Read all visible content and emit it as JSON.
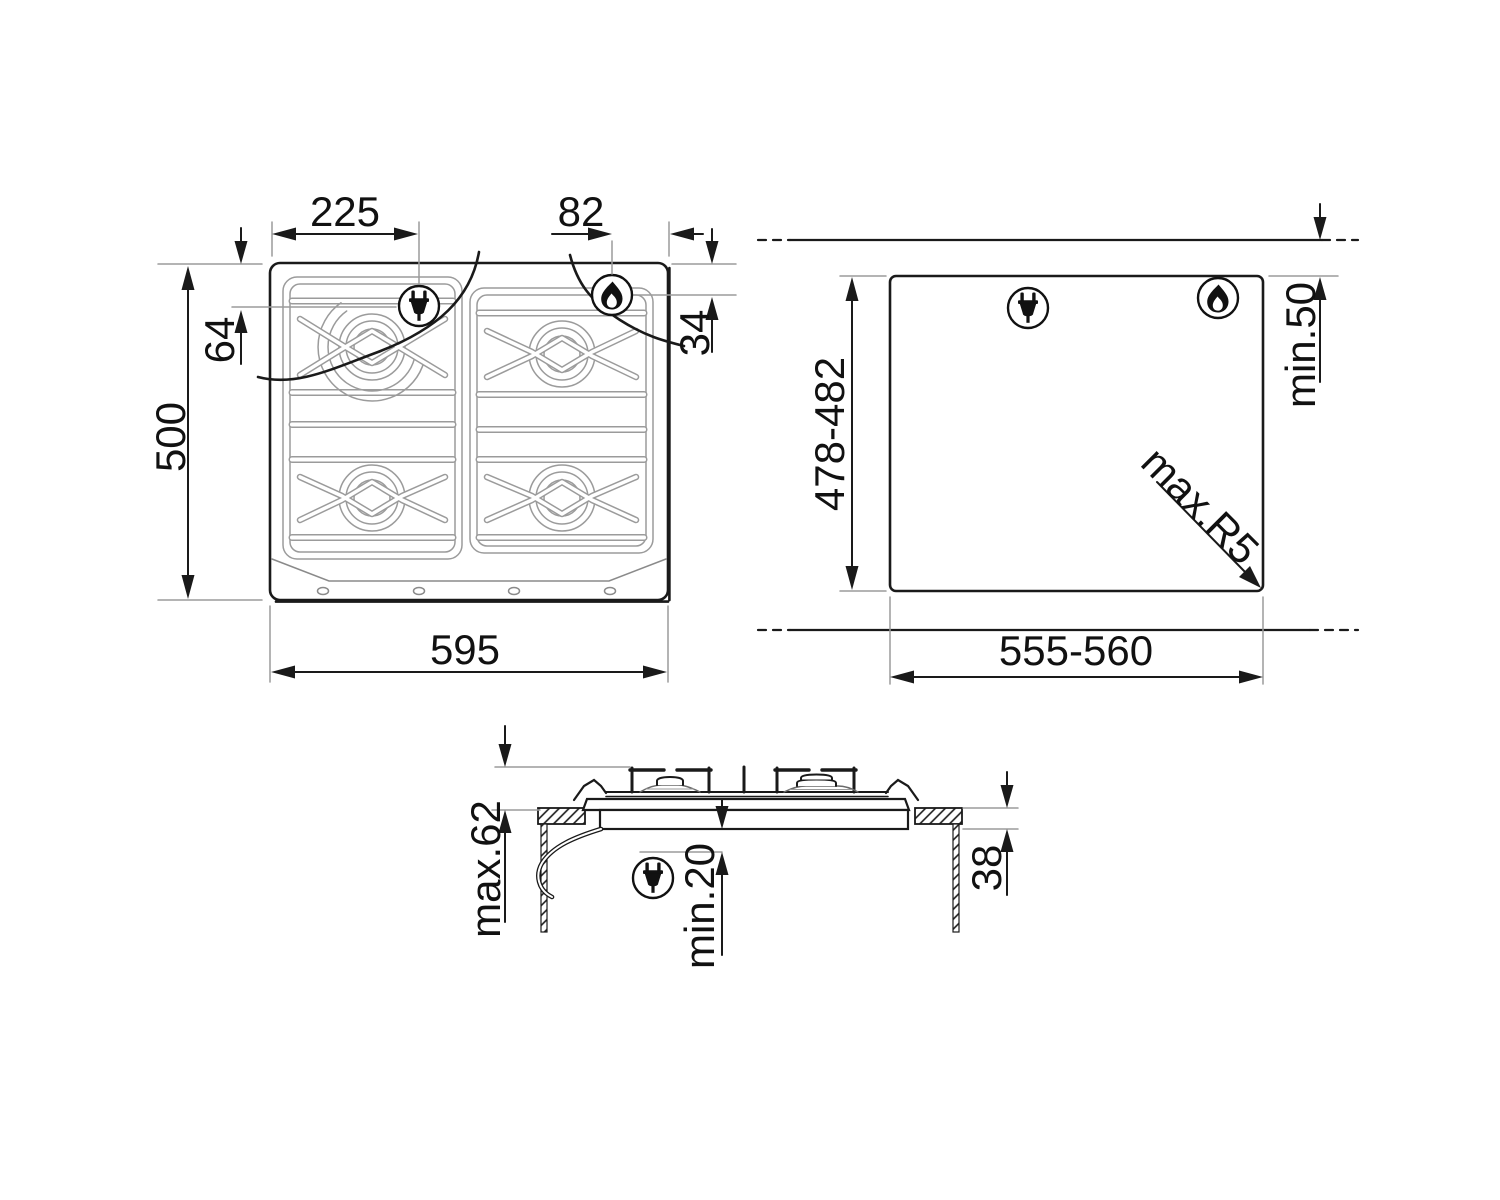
{
  "drawing": {
    "type": "gas-hob installation drawing",
    "colors": {
      "line": "#1a1a1a",
      "thin_line": "#9b9b9b",
      "background": "#ffffff"
    },
    "icons": {
      "plug": "power-plug-icon",
      "flame": "gas-flame-icon"
    }
  },
  "top_view": {
    "width": "595",
    "depth": "500",
    "plug_from_left": "225",
    "plug_from_back": "64",
    "gas_from_right": "82",
    "gas_from_back": "34"
  },
  "cutout_view": {
    "width": "555-560",
    "depth": "478-482",
    "rear_clearance": "min.50",
    "corner_radius": "max.R5"
  },
  "section_view": {
    "overall_height": "max.62",
    "clearance_below": "min.20",
    "recess_depth": "38"
  }
}
